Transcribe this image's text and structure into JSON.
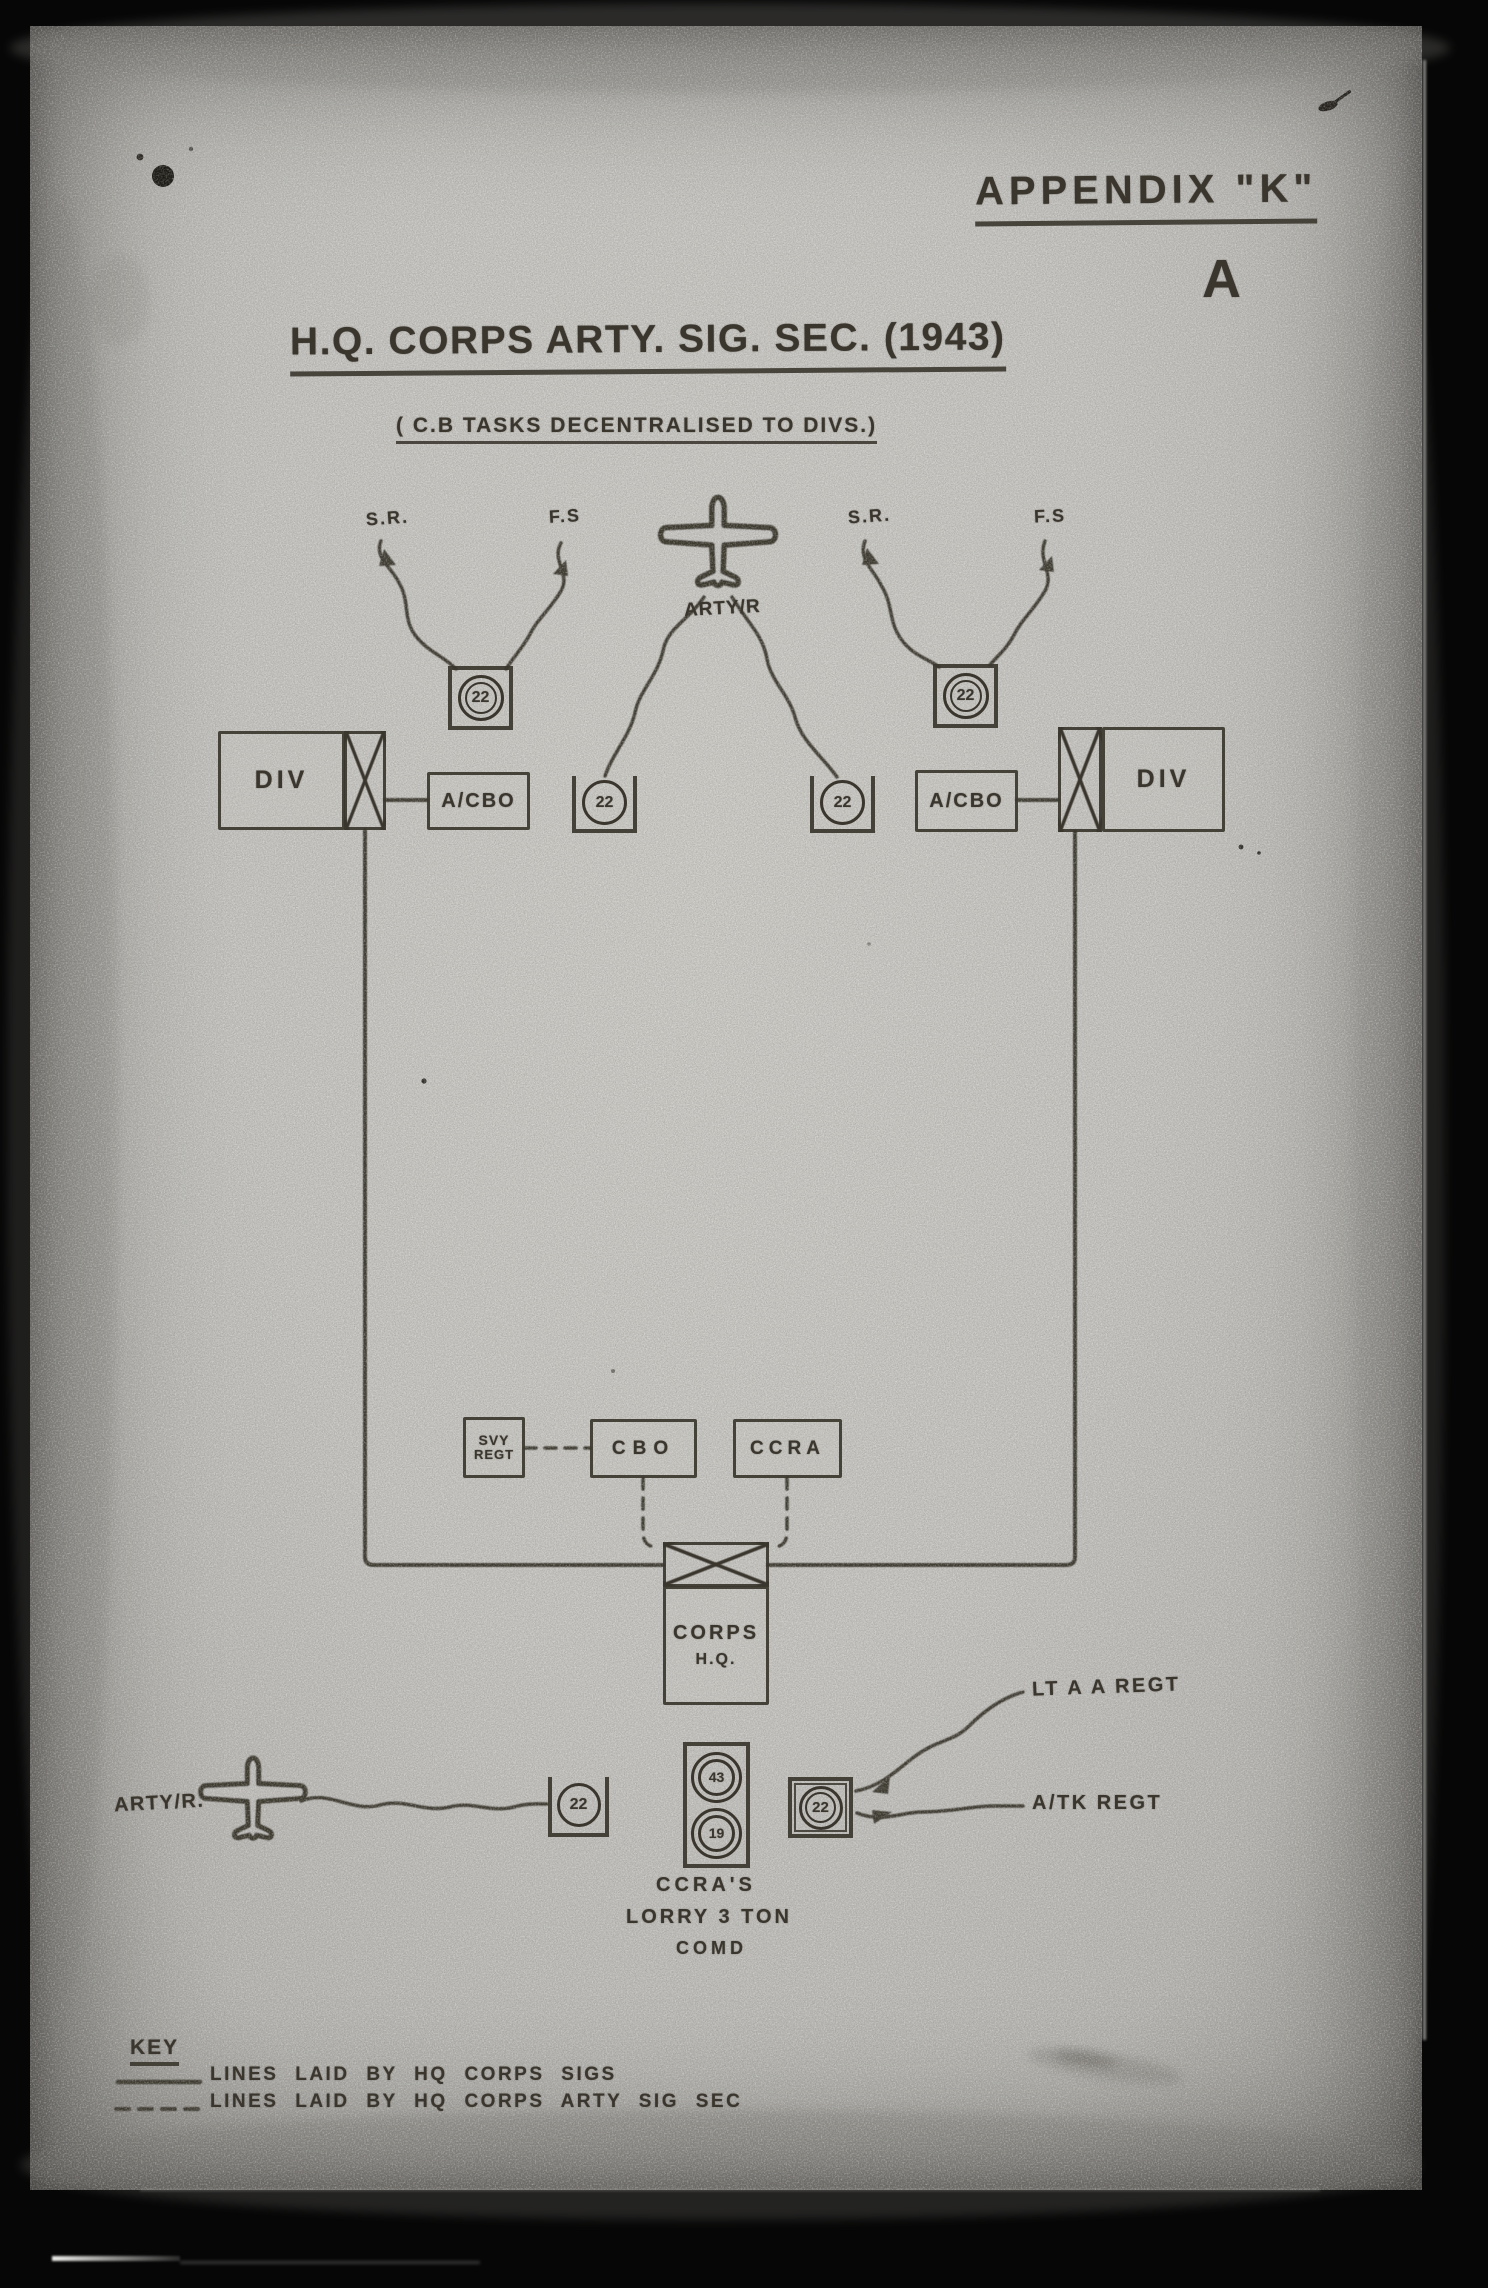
{
  "document": {
    "appendix": "APPENDIX \"K\"",
    "corner_letter": "A",
    "title": "H.Q. CORPS ARTY. SIG. SEC. (1943)",
    "subtitle": "( C.B TASKS DECENTRALISED TO DIVS.)"
  },
  "colors": {
    "ink": "#3a362e",
    "paper": "#c6c5c1"
  },
  "icons": [
    "aircraft-icon",
    "signals-exchange-icon",
    "wireless-set-icon"
  ],
  "top": {
    "left_net": {
      "sr": "S.R.",
      "fs": "F.S",
      "set": "22",
      "div": "DIV",
      "acbo": "A/CBO"
    },
    "right_net": {
      "sr": "S.R.",
      "fs": "F.S",
      "set": "22",
      "div": "DIV",
      "acbo": "A/CBO"
    },
    "air_op": {
      "label": "ARTY/R",
      "left_set": "22",
      "right_set": "22"
    }
  },
  "middle": {
    "svy_regt_line1": "SVY",
    "svy_regt_line2": "REGT",
    "cbo": "CBO",
    "ccra": "CCRA",
    "corps_hq_line1": "CORPS",
    "corps_hq_line2": "H.Q."
  },
  "bottom": {
    "air_label": "ARTY/R.",
    "air_set": "22",
    "lorry_set_top": "43",
    "lorry_set_bottom": "19",
    "command_set": "22",
    "lt_aa_regt": "LT A A REGT",
    "atk_regt": "A/TK REGT",
    "caption_line1": "CCRA'S",
    "caption_line2": "LORRY 3 TON",
    "caption_line3": "COMD"
  },
  "key": {
    "heading": "KEY",
    "entries": [
      {
        "style": "solid",
        "label": "LINES LAID BY HQ CORPS SIGS"
      },
      {
        "style": "dashed",
        "label": "LINES LAID BY HQ CORPS ARTY SIG SEC"
      }
    ]
  }
}
